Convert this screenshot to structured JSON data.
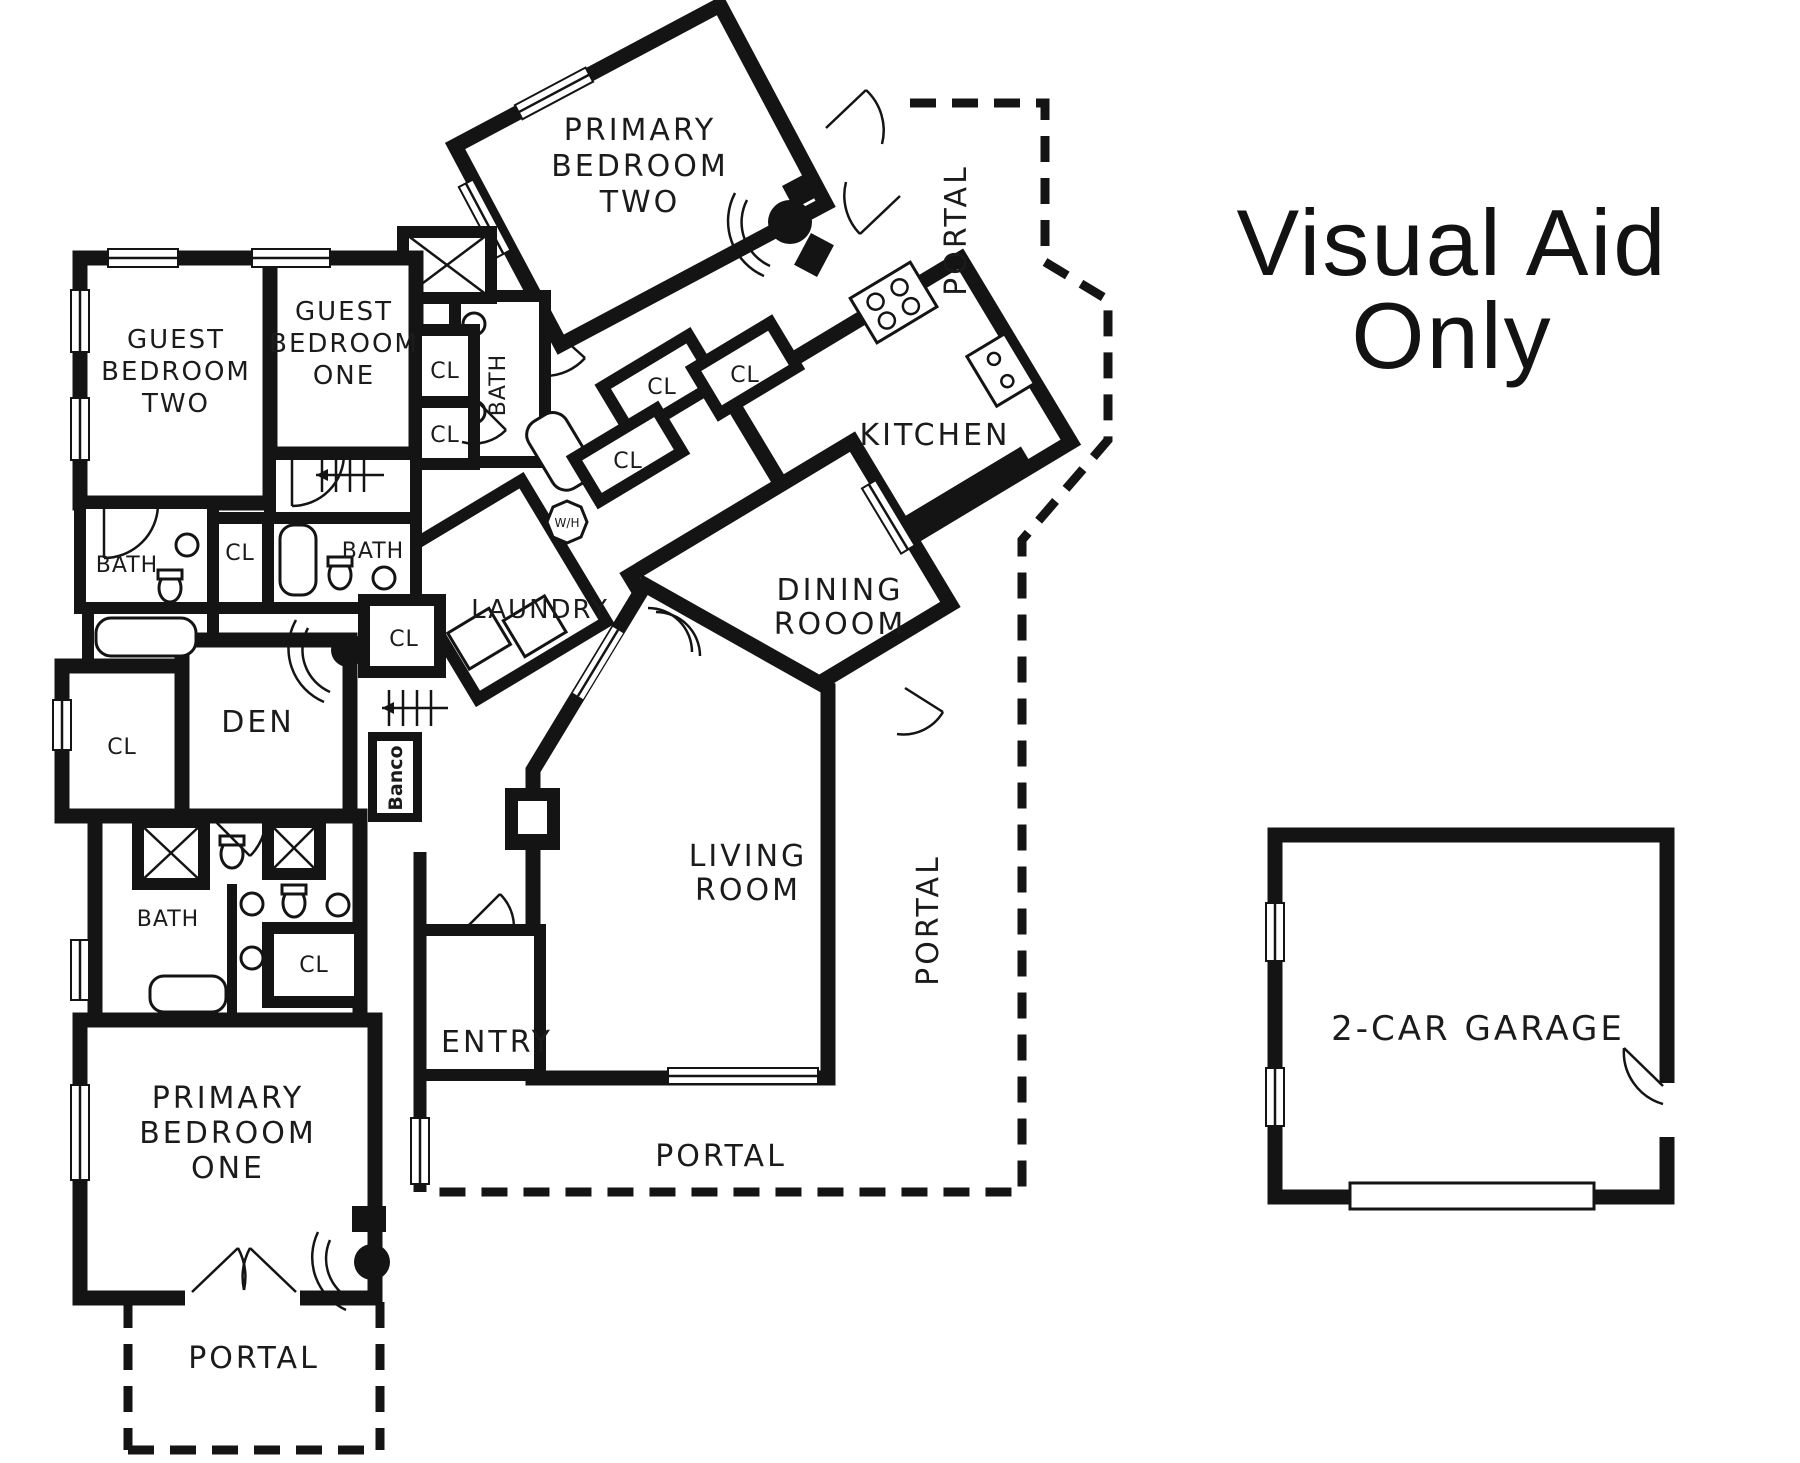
{
  "title": {
    "line1": "Visual Aid",
    "line2": "Only"
  },
  "labels": {
    "bath": "BATH",
    "closet": "CL",
    "portal": "PORTAL",
    "entry": "ENTRY",
    "den": "DEN",
    "banco": "Banco",
    "laundry": "LAUNDRY",
    "kitchen": "KITCHEN",
    "water_heater": "W/H",
    "garage": "2-CAR GARAGE"
  },
  "rooms": {
    "primary_bedroom_two": [
      "PRIMARY",
      "BEDROOM",
      "TWO"
    ],
    "guest_bedroom_two": [
      "GUEST",
      "BEDROOM",
      "TWO"
    ],
    "guest_bedroom_one": [
      "GUEST",
      "BEDROOM",
      "ONE"
    ],
    "dining_room": [
      "DINING",
      "ROOOM"
    ],
    "living_room": [
      "LIVING",
      "ROOM"
    ],
    "primary_bedroom_one": [
      "PRIMARY",
      "BEDROOM",
      "ONE"
    ]
  }
}
